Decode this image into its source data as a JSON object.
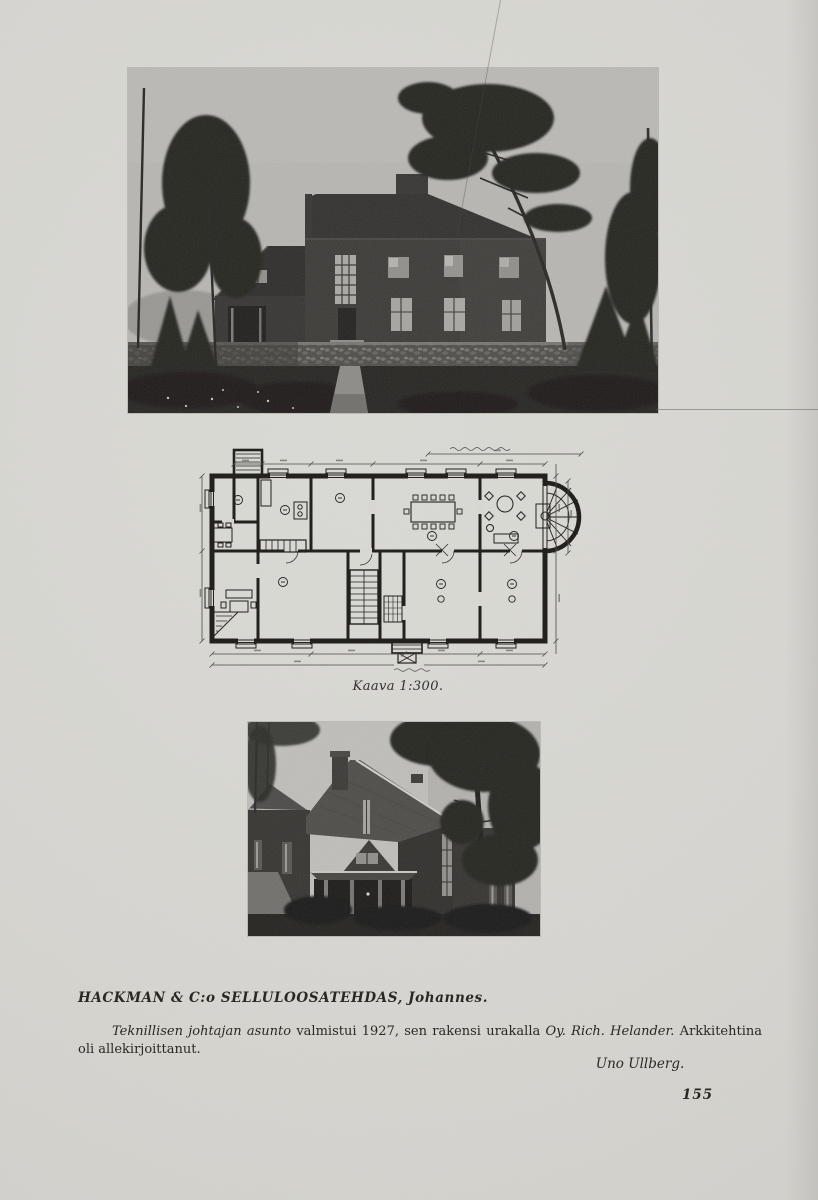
{
  "page": {
    "number": "155"
  },
  "plan": {
    "caption": "Kaava 1:300."
  },
  "article": {
    "heading": "HACKMAN & C:o SELLULOOSATEHDAS, Johannes.",
    "body": [
      {
        "text": "Teknillisen johtajan asunto",
        "style": "italic"
      },
      {
        "text": " valmistui 1927, sen rakensi urakalla ",
        "style": "roman"
      },
      {
        "text": "Oy. Rich. Helander.",
        "style": "italic"
      },
      {
        "text": " Arkkitehtina oli allekirjoittanut.",
        "style": "roman"
      }
    ],
    "signature": "Uno Ullberg."
  },
  "figures": {
    "top_photo": {
      "description": "front-elevation-photograph-of-residence-among-pines"
    },
    "plan_drawing": {
      "description": "ground-floor-plan-scale-1-300"
    },
    "bottom_photo": {
      "description": "corner-view-photograph-of-residence-with-gable-roof-and-porch"
    }
  },
  "colors": {
    "paper": "#d8d7d2",
    "ink": "#26251f",
    "photo_sky": "#b7b6b2",
    "photo_dark": "#23221f"
  }
}
